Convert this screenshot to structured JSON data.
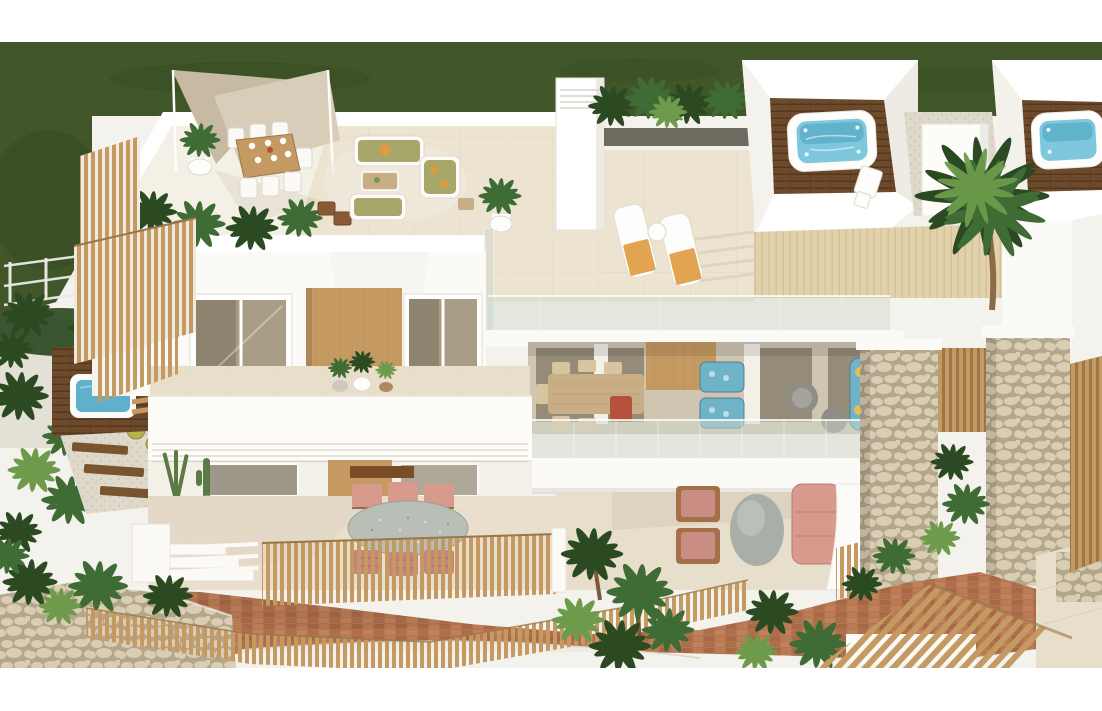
{
  "image": {
    "kind": "architectural-3d-render",
    "description": "Aerial 3D rendering of a modern white villa: rooftop terrace with triangular shade sail, outdoor dining and olive-green lounge set, two rooftop jacuzzis on dark timber decks, white sun loungers with orange towels, tall palm tree, stone-clad pillars, glass balustrades, balcony with blue lounge furniture, ground terrace with pink armchairs and sofa, plunge pool on timber deck, timber picket fences, brick garden path and dark green lawn",
    "frame": {
      "width": 1102,
      "height": 711,
      "white_margin_top": 42,
      "white_margin_bottom": 43
    }
  },
  "palette": {
    "white": "#ffffff",
    "warm_white": "#fbfaf6",
    "off_white": "#f4f2ec",
    "wall_shade": "#edebe3",
    "grass": "#41572a",
    "grass_dark": "#2f421d",
    "deck_tile": "#ece3d0",
    "deck_pale": "#f6f2e9",
    "deck_wood_light": "#e2d2ab",
    "plank_brown": "#6d4a2c",
    "plank_brown_dark": "#55371e",
    "wood": "#c49a62",
    "wood_dark": "#9a7748",
    "wood_deep": "#7a542e",
    "water": "#7ec7dd",
    "water_deep": "#4fa3c0",
    "pool_water": "#5fb0cc",
    "glass": "#cfd9cc",
    "stone": "#d9cdb4",
    "stone_joint": "#b3a68b",
    "brick": "#b57450",
    "brick_dark": "#9a5f3e",
    "brick_light": "#c98f63",
    "plant": "#3f6b35",
    "plant_dark": "#2b4a22",
    "plant_light": "#6d9b4b",
    "sail": "#d8cdb9",
    "sail_dark": "#c6baa2",
    "olive": "#a6a768",
    "orange": "#e09a3f",
    "pink": "#d99a8e",
    "pink_dark": "#c5857b",
    "terracotta": "#b5503b",
    "blue": "#6fb3c8",
    "blue_dark": "#4d7f93",
    "yellow": "#e3bd55",
    "granite": "#b9beb7",
    "interior_wall": "#cfc5b1",
    "opening": "#8b8270",
    "gravel": "#dfd9cc",
    "pale_ground": "#efece3",
    "rattan": "#c9ae85",
    "cactus": "#5c7a46",
    "barrel_cactus": "#b5b24e",
    "trunk": "#8a6a48"
  },
  "scene": {
    "regions": [
      "lawn",
      "garden-wire-fence",
      "side-garden",
      "plunge-pool-deck",
      "timber-fin-screens",
      "rooftop-terrace",
      "shade-sail",
      "rooftop-dining-set",
      "rooftop-lounge-set",
      "chimney",
      "planter-hedge",
      "sun-loungers",
      "jacuzzi-left",
      "jacuzzi-right",
      "palm-tree",
      "glass-balustrade",
      "upper-balcony",
      "facade-windows",
      "middle-floor-lounge",
      "ground-terrace-pink",
      "stone-pillars",
      "patio-dining",
      "picket-fences",
      "brick-path",
      "stone-retaining-wall",
      "pergola",
      "tropical-plants"
    ]
  }
}
